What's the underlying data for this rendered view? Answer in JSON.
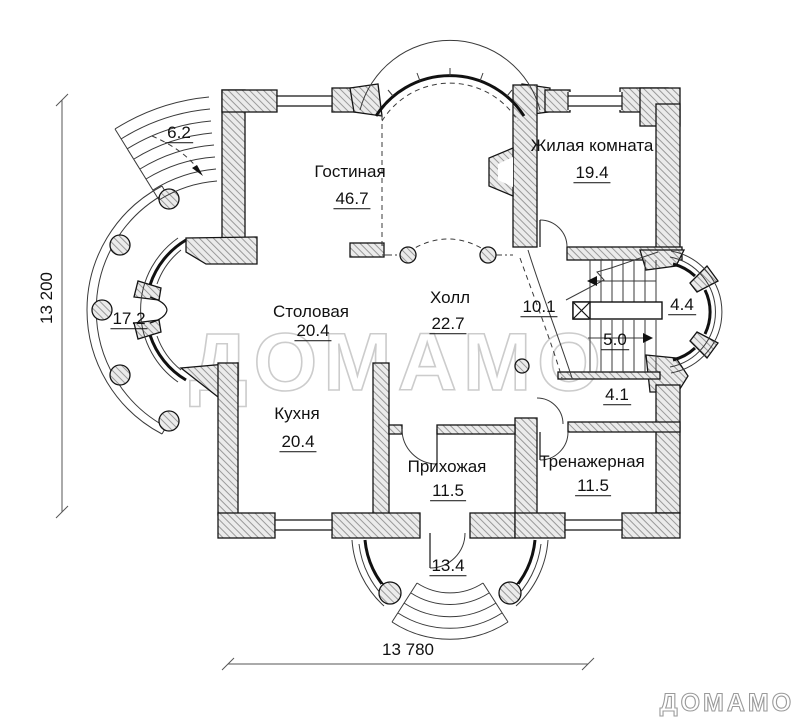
{
  "watermark": {
    "center": "ДОМАМО",
    "logo": "ДОМАМО"
  },
  "dimensions": {
    "height": "13 200",
    "width": "13 780"
  },
  "rooms": [
    {
      "name": "Гостиная",
      "area": "46.7"
    },
    {
      "name": "Жилая комната",
      "area": "19.4"
    },
    {
      "name": "Столовая",
      "area": "20.4"
    },
    {
      "name": "Холл",
      "area": "22.7"
    },
    {
      "name": "Кухня",
      "area": "20.4"
    },
    {
      "name": "Прихожая",
      "area": "11.5"
    },
    {
      "name": "Тренажерная",
      "area": "11.5"
    }
  ],
  "open_areas": [
    {
      "label": "6.2"
    },
    {
      "label": "17.2"
    },
    {
      "label": "10.1"
    },
    {
      "label": "4.4"
    },
    {
      "label": "5.0"
    },
    {
      "label": "4.1"
    },
    {
      "label": "13.4"
    }
  ],
  "colors": {
    "wall_hatch_bg": "#ebebeb",
    "wall_hatch_line": "#999999",
    "line": "#141414",
    "watermark": "#cccccc"
  }
}
